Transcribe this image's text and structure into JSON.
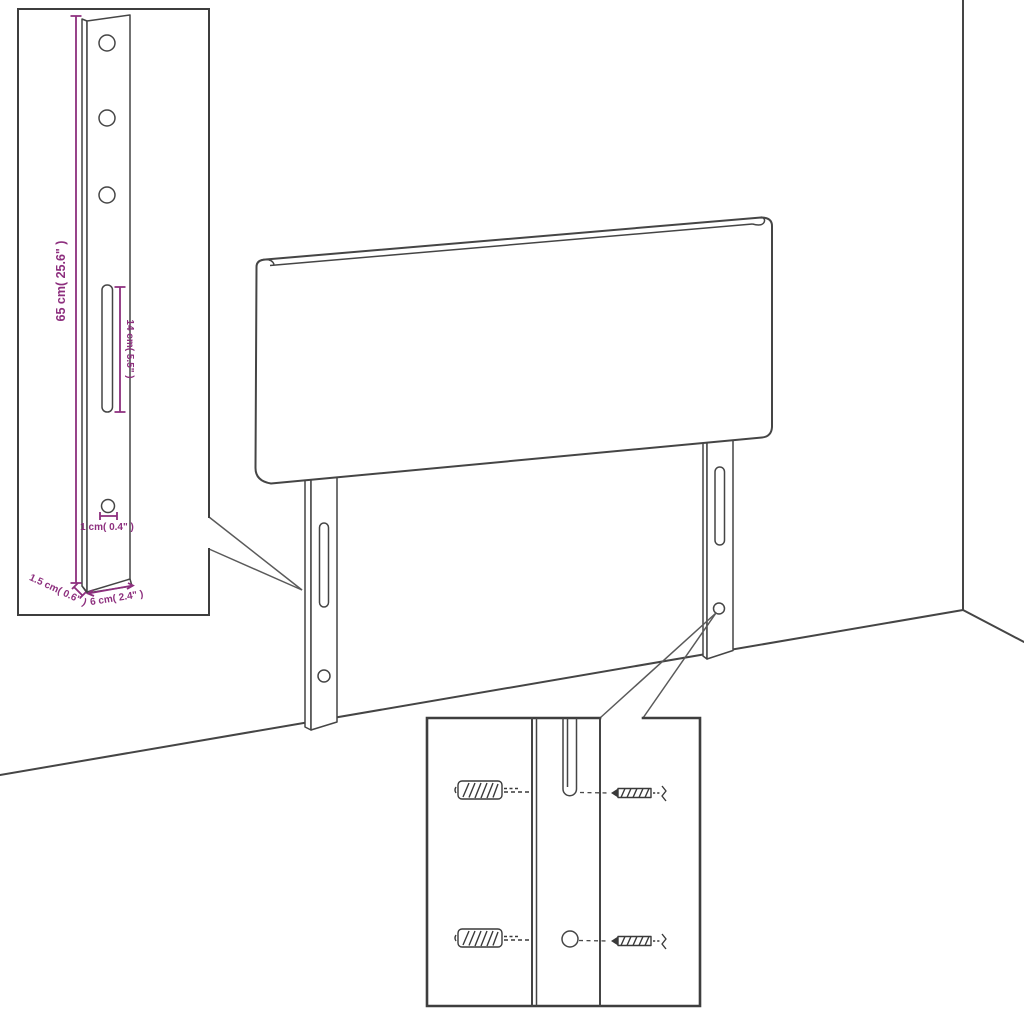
{
  "page": {
    "background": "#ffffff"
  },
  "colors": {
    "line": "#454545",
    "inset_border": "#3e3e3e",
    "dimension": "#8d2f7e"
  },
  "diagram": {
    "subject": "headboard with two mounting legs shown against a room corner",
    "insets": [
      "leg dimension detail",
      "wall mounting hardware detail"
    ]
  },
  "dimensions": {
    "leg_height": {
      "label": "65 cm( 25.6\" )"
    },
    "slot_length": {
      "label": "14 cm( 5.5\" )"
    },
    "hole_size": {
      "label": "1 cm( 0.4\" )"
    },
    "leg_thickness": {
      "label": "1.5 cm( 0.6\" )"
    },
    "leg_width": {
      "label": "6 cm( 2.4\" )"
    }
  }
}
